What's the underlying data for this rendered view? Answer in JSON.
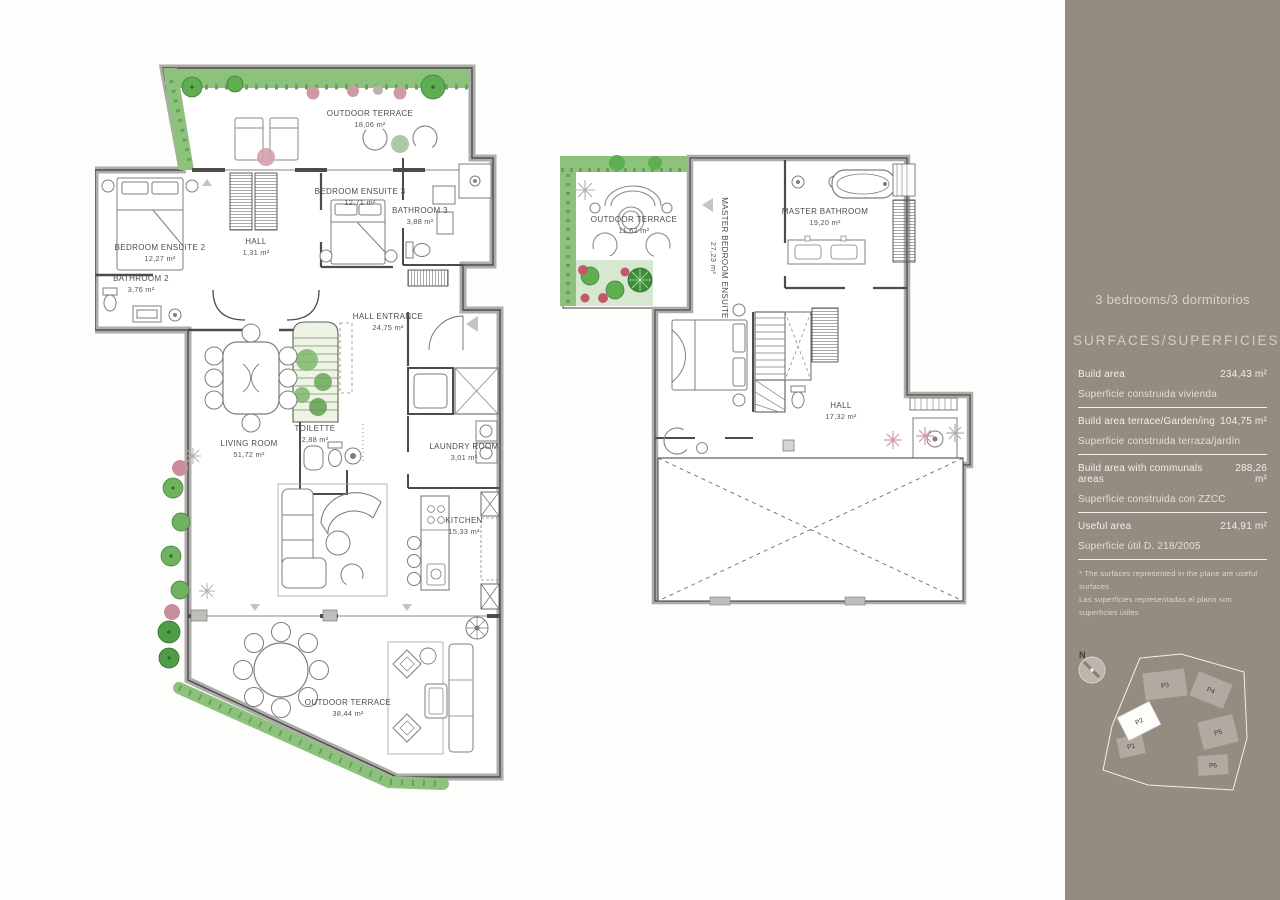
{
  "page": {
    "background": "#fdfdfb"
  },
  "sidebar": {
    "background": "#948b81",
    "title": "3 bedrooms/3 dormitorios",
    "section_title": "SURFACES/SUPERFICIES",
    "rows": [
      {
        "label_en": "Build area",
        "value": "234,43 m²",
        "label_es": "Superficie construida vivienda"
      },
      {
        "label_en": "Build area terrace/Garden/ing",
        "value": "104,75 m²",
        "label_es": "Superficie construida terraza/jardín"
      },
      {
        "label_en": "Build area with communals areas",
        "value": "288,26 m²",
        "label_es": "Superficie construida con ZZCC"
      },
      {
        "label_en": "Useful area",
        "value": "214,91 m²",
        "label_es": "Superficie útil  D. 218/2005"
      }
    ],
    "footnote_en": "* The surfaces represented in the plane are useful surfaces",
    "footnote_es": "Las superficies representadas  el plano son superficies útiles",
    "compass_label": "N",
    "siteplan": {
      "highlighted": "P2",
      "buildings": [
        {
          "id": "P3"
        },
        {
          "id": "P4"
        },
        {
          "id": "P5"
        },
        {
          "id": "P6"
        },
        {
          "id": "P1"
        },
        {
          "id": "P2"
        }
      ]
    }
  },
  "floor1": {
    "outdoor_terrace_top": {
      "name": "OUTDOOR TERRACE",
      "area": "18,06 m²"
    },
    "bedroom_ensuite_2": {
      "name": "BEDROOM ENSUITE 2",
      "area": "12,27 m²"
    },
    "bathroom_2": {
      "name": "BATHROOM 2",
      "area": "3,76 m²"
    },
    "hall": {
      "name": "HALL",
      "area": "1,31 m²"
    },
    "bedroom_ensuite_3": {
      "name": "BEDROOM ENSUITE 3",
      "area": "12,71 m²"
    },
    "bathroom_3": {
      "name": "BATHROOM 3",
      "area": "3,88 m²"
    },
    "hall_entrance": {
      "name": "HALL ENTRANCE",
      "area": "24,75 m²"
    },
    "living_room": {
      "name": "LIVING ROOM",
      "area": "51,72 m²"
    },
    "toilette": {
      "name": "TOILETTE",
      "area": "2,88 m²"
    },
    "laundry_room": {
      "name": "LAUNDRY ROOM",
      "area": "3,01 m²"
    },
    "kitchen": {
      "name": "KITCHEN",
      "area": "15,33 m²"
    },
    "outdoor_terrace_bottom": {
      "name": "OUTDOOR TERRACE",
      "area": "38,44 m²"
    }
  },
  "floor2": {
    "outdoor_terrace": {
      "name": "OUTDOOR TERRACE",
      "area": "11,62 m²"
    },
    "master_bedroom": {
      "name": "MASTER BEDROOM ENSUITE",
      "area": "27,23 m²"
    },
    "master_bathroom": {
      "name": "MASTER BATHROOM",
      "area": "19,20 m²"
    },
    "hall": {
      "name": "HALL",
      "area": "17,32 m²"
    }
  },
  "colors": {
    "hedge": "#8cc27c",
    "hedge_dark": "#69a05b",
    "tree": "#5faf52",
    "flower_pink": "#cf9ba3",
    "wall_fill": "#aeaca8",
    "wall_line": "#4c4c4c",
    "stairs_fill": "#edf4e4"
  }
}
